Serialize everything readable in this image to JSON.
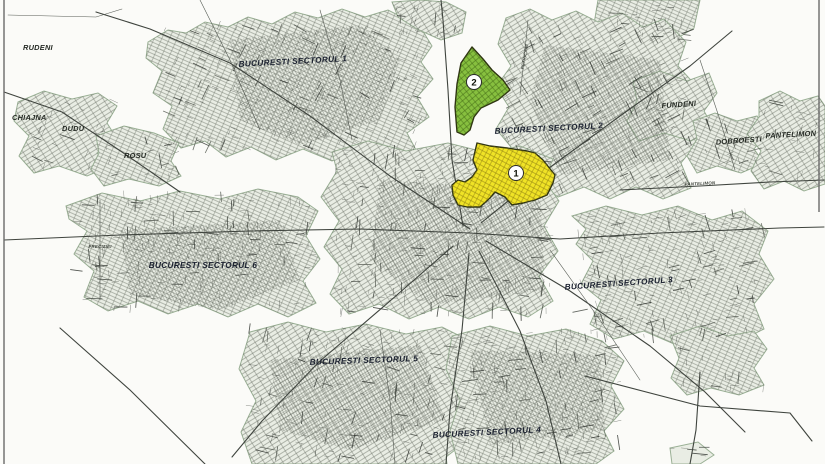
{
  "map": {
    "title": "Bucharest city sectors map with two highlighted zones",
    "colors": {
      "background": "#fbfbf8",
      "urban_fill": "#e9ede4",
      "road": "#3f443e",
      "boundary": "#9ab095",
      "zone1_fill": "#f0e326",
      "zone2_fill": "#87c03f",
      "label": "#1b2130"
    }
  },
  "zones": [
    {
      "number": "1",
      "area": "yellow highlighted zone"
    },
    {
      "number": "2",
      "area": "green highlighted zone"
    }
  ],
  "sector_labels": [
    {
      "text": "BUCURESTI SECTORUL 1"
    },
    {
      "text": "BUCURESTI SECTORUL 2"
    },
    {
      "text": "BUCURESTI SECTORUL 3"
    },
    {
      "text": "BUCURESTI SECTORUL 4"
    },
    {
      "text": "BUCURESTI SECTORUL 5"
    },
    {
      "text": "BUCURESTI SECTORUL 6"
    }
  ],
  "place_labels": [
    {
      "text": "RUDENI"
    },
    {
      "text": "CHIAJNA"
    },
    {
      "text": "DUDU"
    },
    {
      "text": "ROSU"
    },
    {
      "text": "FUNDENI"
    },
    {
      "text": "DOBROESTI"
    },
    {
      "text": "PANTELIMON"
    }
  ],
  "street_labels": [
    {
      "text": "PETRICANI"
    },
    {
      "text": "PRECIZIEI"
    },
    {
      "text": "PANTELIMON"
    }
  ]
}
